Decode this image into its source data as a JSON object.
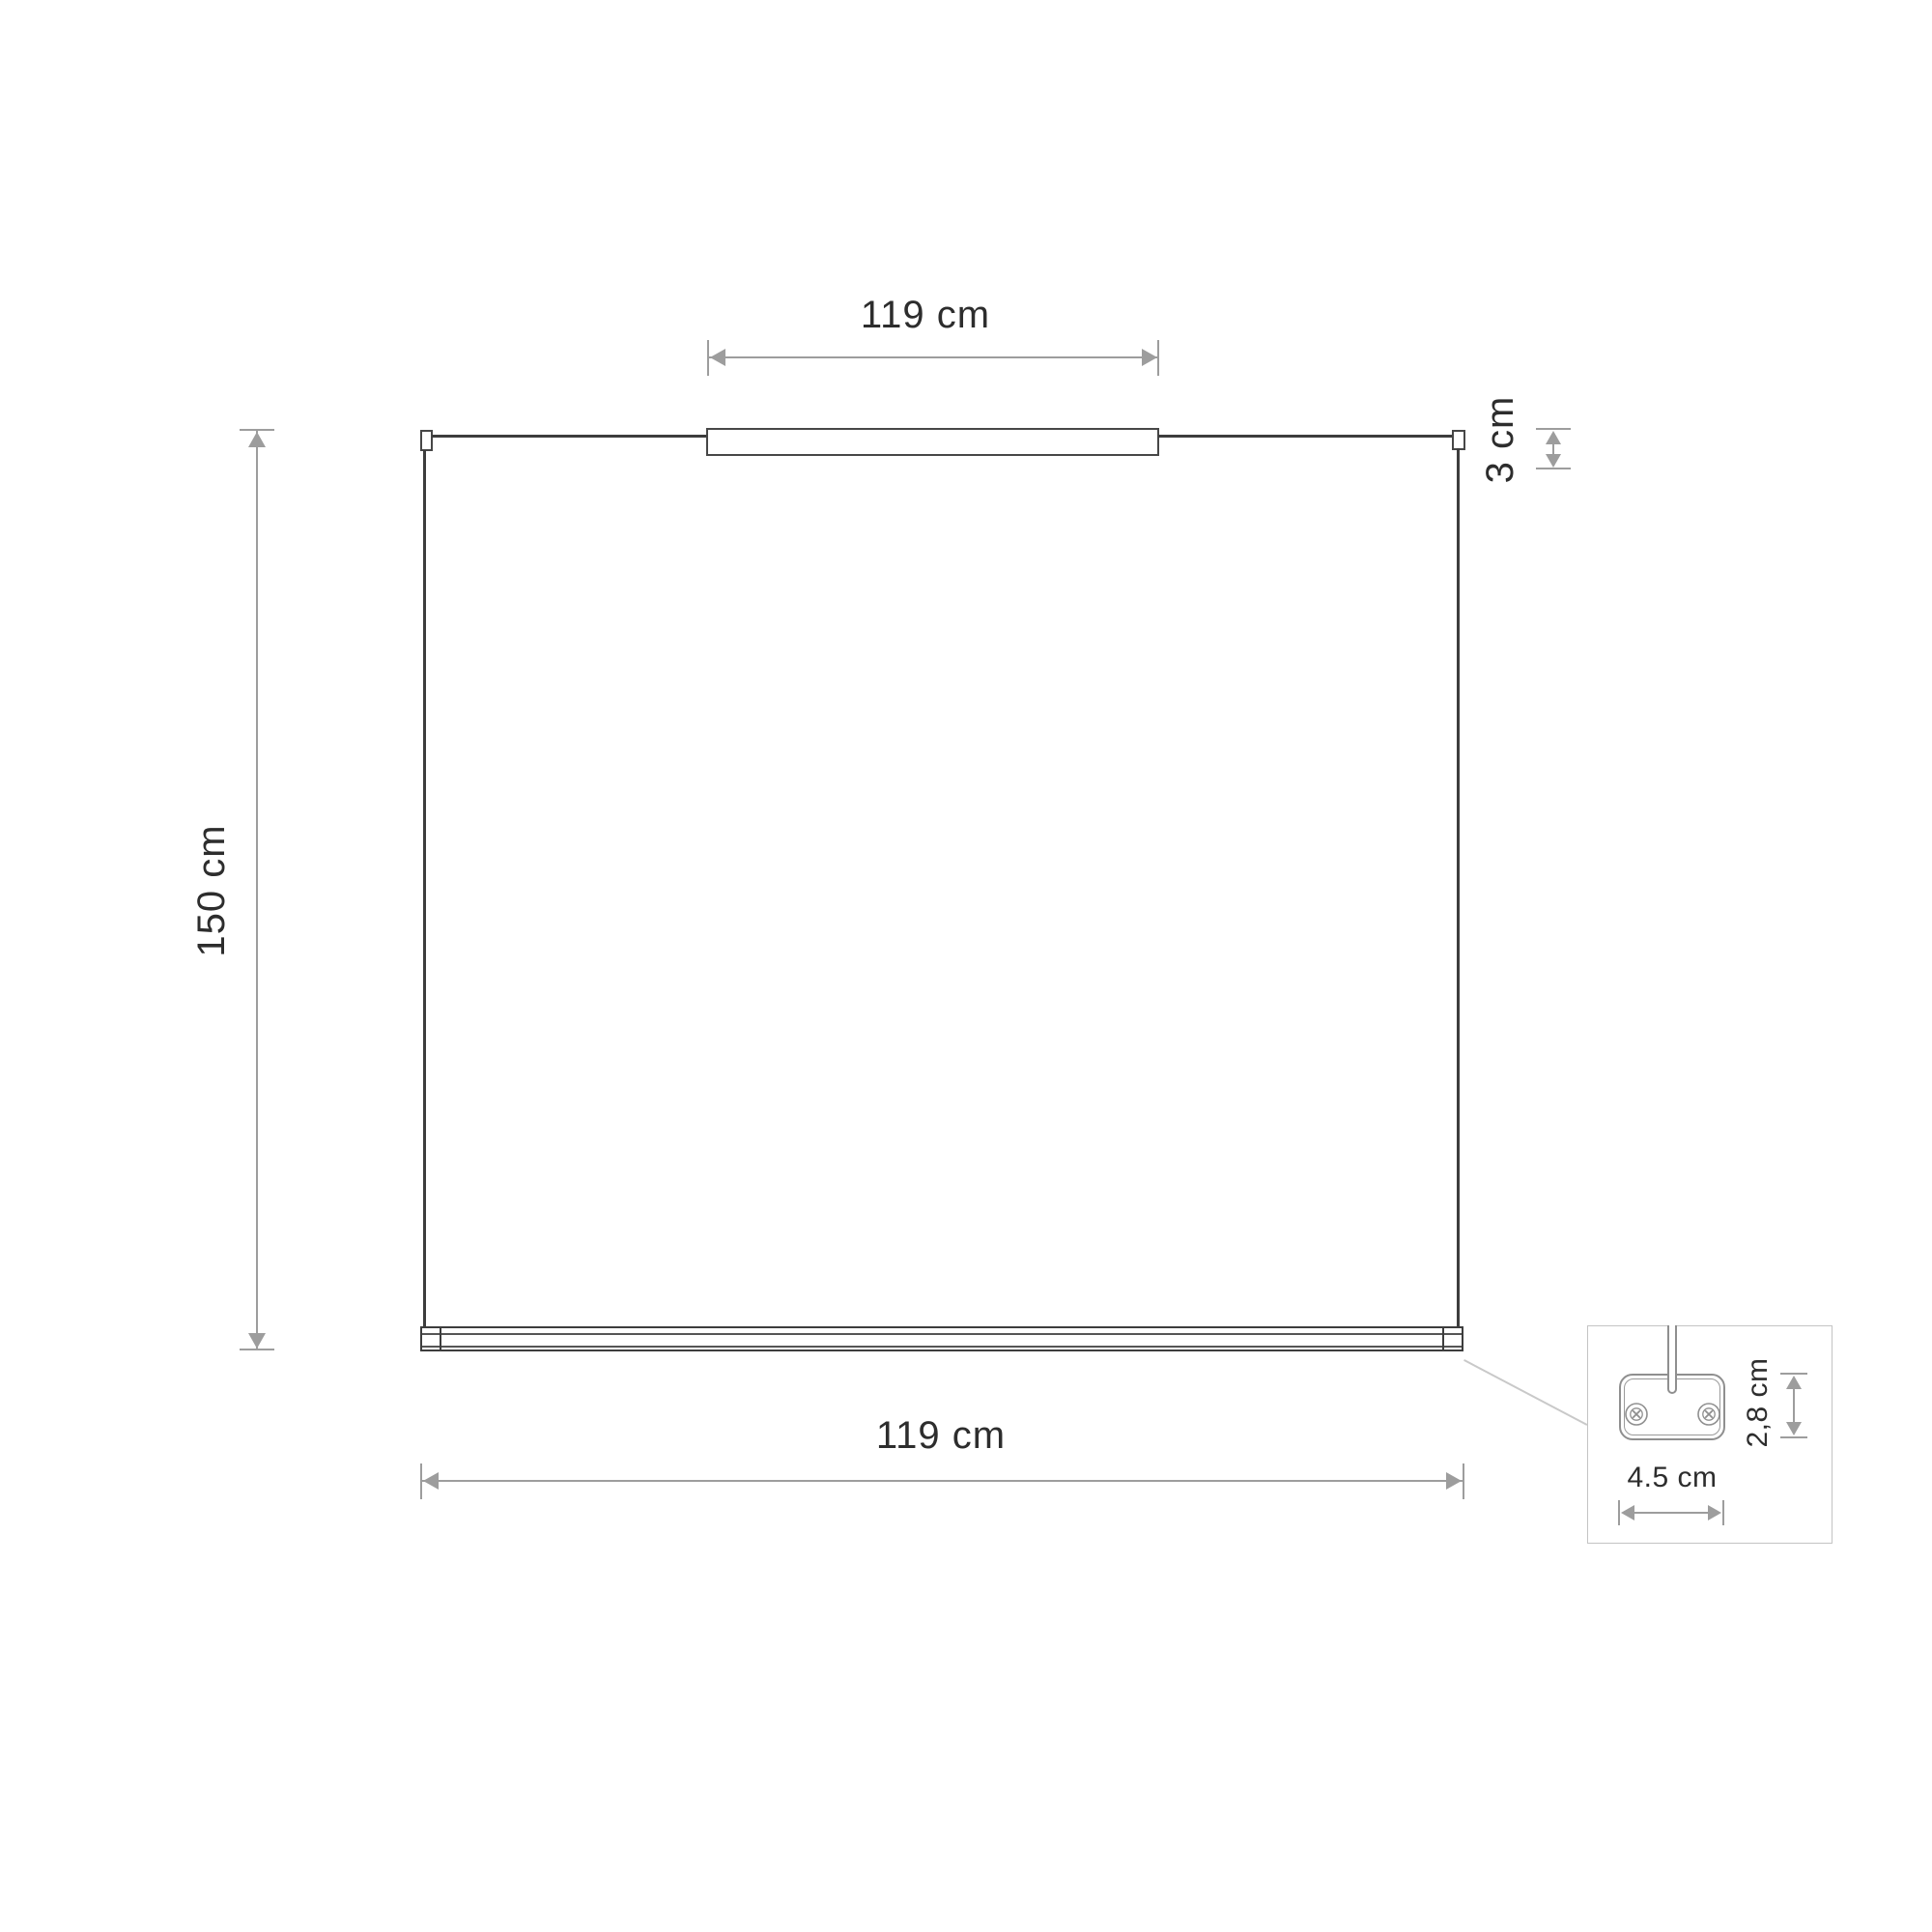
{
  "dimensions": {
    "top_width": "119 cm",
    "housing_height": "3 cm",
    "suspension_height": "150 cm",
    "bottom_width": "119 cm",
    "bracket_width": "4.5 cm",
    "bracket_height": "2,8 cm"
  },
  "colors": {
    "background": "#ffffff",
    "product_line": "#3d3d3d",
    "dimension_line": "#9d9d9d",
    "text": "#2d2d2d",
    "detail_border": "#c4c4c4",
    "bracket_line": "#8f8f8f"
  }
}
